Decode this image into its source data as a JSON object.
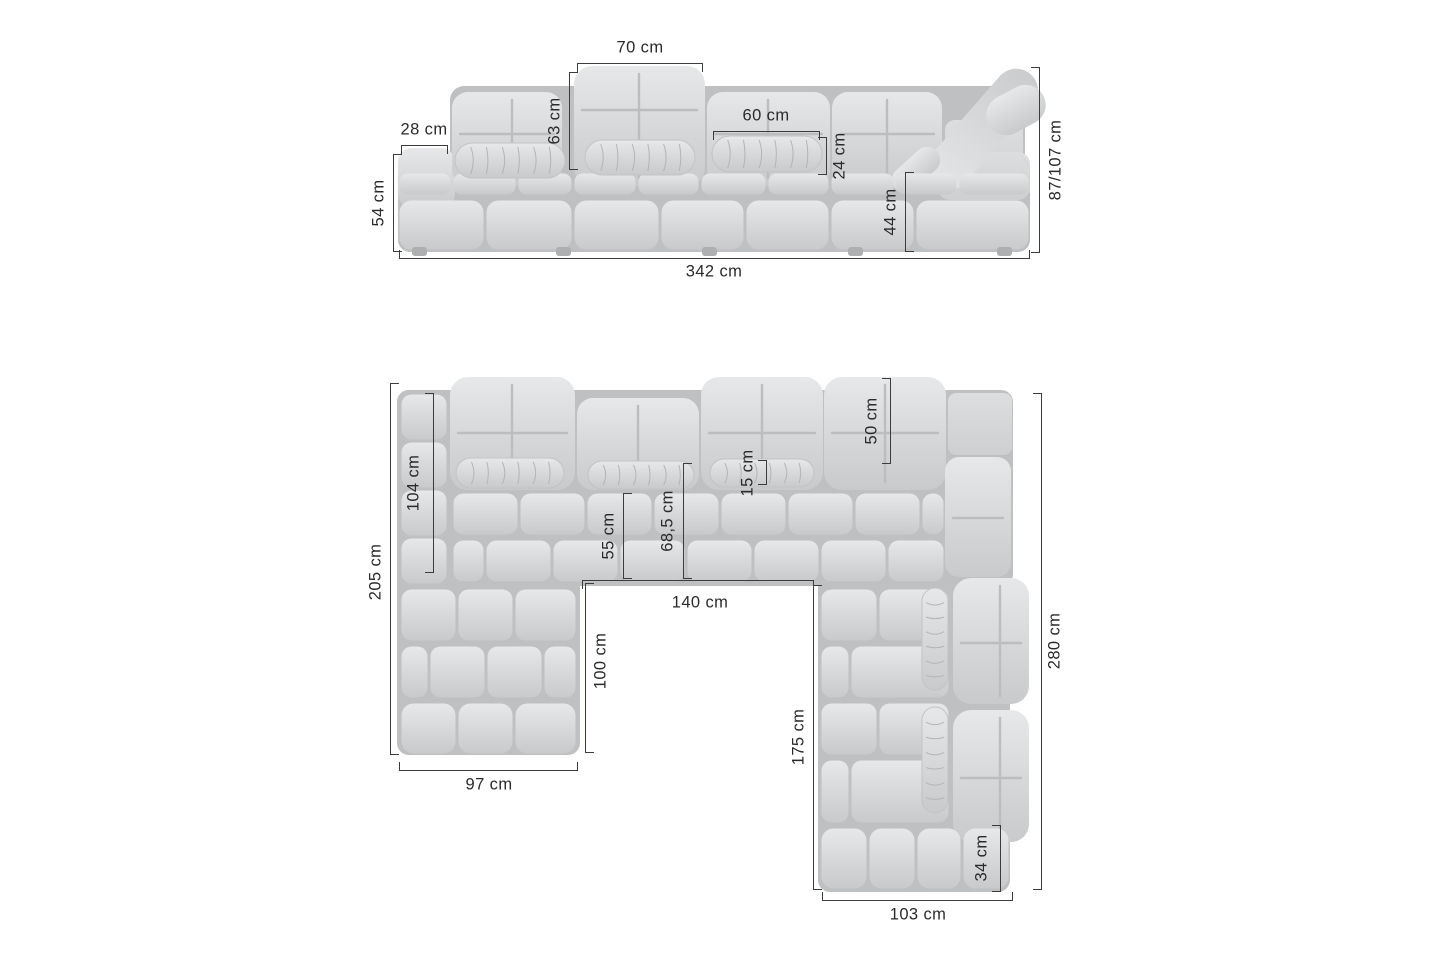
{
  "front_view": {
    "headrest_width": "70 cm",
    "left_armrest_width": "28 cm",
    "backrest_height": "63 cm",
    "cushion_width": "60 cm",
    "cushion_height": "24 cm",
    "armrest_height": "54 cm",
    "seat_height": "44 cm",
    "total_height": "87/107 cm",
    "total_width": "342 cm"
  },
  "top_view": {
    "left_backrest_depth": "104 cm",
    "right_backrest_depth": "50 cm",
    "bolster_depth": "15 cm",
    "seat_depth": "55 cm",
    "seat_depth_with_bolster": "68,5 cm",
    "left_side_length": "205 cm",
    "inner_width": "140 cm",
    "inner_left_length": "100 cm",
    "inner_right_length": "175 cm",
    "right_side_length": "280 cm",
    "left_chaise_width": "97 cm",
    "corner_end_depth": "34 cm",
    "right_chaise_width": "103 cm"
  }
}
